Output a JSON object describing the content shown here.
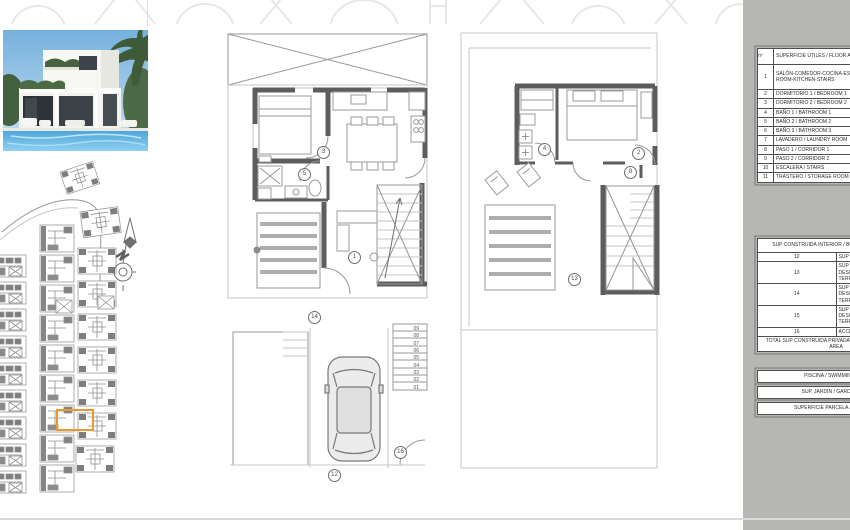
{
  "sheet": {
    "panel_bg": "#b6b7b3",
    "highlight_color": "#e69b30",
    "wall_color": "#5d5d5d"
  },
  "icons": {
    "north_arrow": "north-arrow-icon",
    "villa_photo": "villa-render-photo"
  },
  "legend_table": {
    "header": {
      "num": "nº",
      "label": "SUPERFICIE ÚTILES / FLOOR AREAS"
    },
    "rows": [
      {
        "num": "1",
        "label": "SALÓN-COMEDOR-COCINA-ESCALERA / LIVING-DINING ROOM-KITCHEN-STAIRS"
      },
      {
        "num": "2",
        "label": "DORMITORIO 1 / BEDROOM 1"
      },
      {
        "num": "3",
        "label": "DORMITORIO 2 / BEDROOM 2"
      },
      {
        "num": "4",
        "label": "BAÑO 1 / BATHROOM 1"
      },
      {
        "num": "5",
        "label": "BAÑO 2 / BATHROOM 2"
      },
      {
        "num": "6",
        "label": "BAÑO 3 / BATHROOM 3"
      },
      {
        "num": "7",
        "label": "LAVADERO / LAUNDRY ROOM"
      },
      {
        "num": "8",
        "label": "PASO 1 / CORRIDOR 1"
      },
      {
        "num": "9",
        "label": "PASO 2 / CORRIDOR 2"
      },
      {
        "num": "10",
        "label": "ESCALERA / STAIRS"
      },
      {
        "num": "11",
        "label": "TRASTERO / STORAGE ROOM"
      },
      {
        "num": "12",
        "label": "SUP GARAJE / GARAGE AREA"
      },
      {
        "num": "13",
        "label": "SUP CONSTRUIDA TERRAZA DESCUBIERTA 1 / BUILT OPEN TERRACE AREA 1"
      },
      {
        "num": "14",
        "label": "SUP CONSTRUIDA TERRAZA DESCUBIERTA 2 / BUILT OPEN TERRACE AREA 2"
      },
      {
        "num": "15",
        "label": "SUP CONSTRUIDA TERRAZA DESCUBIERTA 3 / BUILT OPEN TERRACE AREA 3"
      },
      {
        "num": "16",
        "label": "ACCESO / ACCESS"
      }
    ],
    "section2_header": "SUP CONSTRUIDA INTERIOR / BUILT INTERIOR AREA",
    "total_row": "TOTAL SUP CONSTRUIDA PRIVADA / TOTAL BUILT PRIVATE AREA",
    "bars": [
      "PISCINA / SWIMMING POOL",
      "SUP. JARDÍN / GARDEN AREA",
      "SUPERFICIE PARCELA / PLOT AREA"
    ]
  },
  "plans": {
    "ground": {
      "markers": [
        {
          "label": "3"
        },
        {
          "label": "5"
        },
        {
          "label": "1"
        },
        {
          "label": "14"
        },
        {
          "label": "12"
        },
        {
          "label": "16"
        }
      ],
      "stair_steps": [
        "09",
        "08",
        "07",
        "06",
        "05",
        "04",
        "03",
        "02",
        "01"
      ]
    },
    "first": {
      "markers": [
        {
          "label": "4"
        },
        {
          "label": "2"
        },
        {
          "label": "8"
        },
        {
          "label": "13"
        }
      ]
    }
  }
}
